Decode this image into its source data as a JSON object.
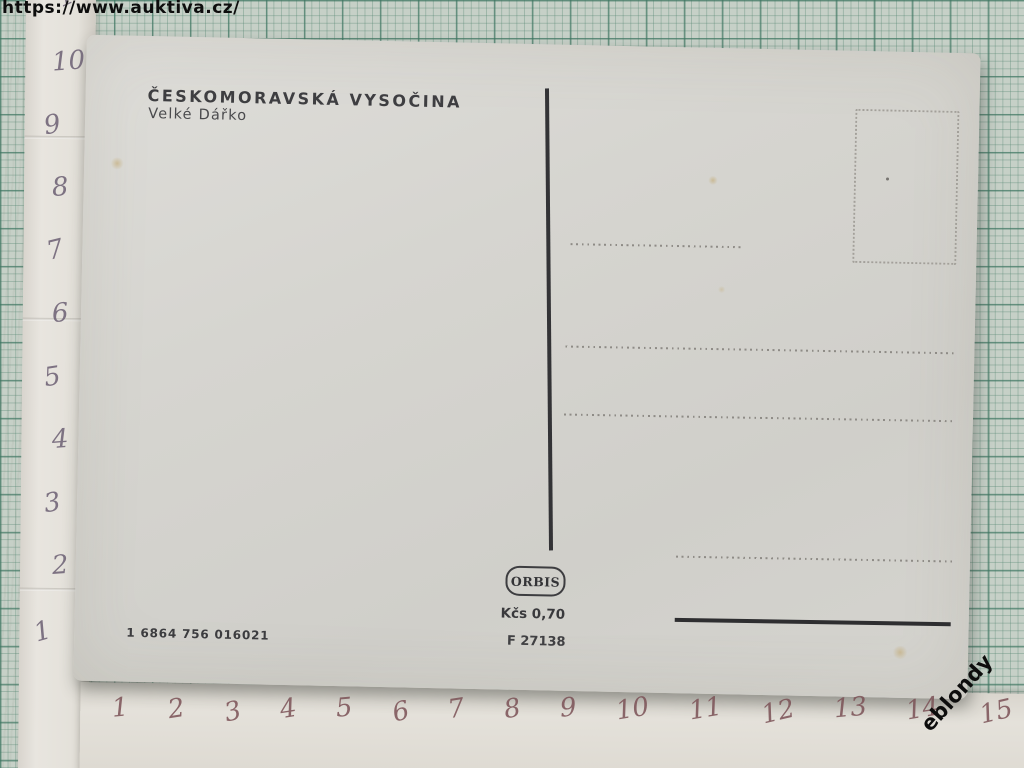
{
  "watermarks": {
    "url": "https://www.auktiva.cz/",
    "seller": "eblondy"
  },
  "postcard": {
    "title": "ČESKOMORAVSKÁ VYSOČINA",
    "subtitle": "Velké Dářko",
    "publisher_logo": "ORBIS",
    "price": "Kčs 0,70",
    "catalog_code": "F 27138",
    "print_code": "1 6864 756 016021"
  },
  "rulers": {
    "left_numbers": [
      "11",
      "10",
      "9",
      "8",
      "7",
      "6",
      "5",
      "4",
      "3",
      "2",
      "1"
    ],
    "bottom_numbers": [
      "1",
      "2",
      "3",
      "4",
      "5",
      "6",
      "7",
      "8",
      "9",
      "10",
      "11",
      "12",
      "13",
      "14",
      "15"
    ]
  },
  "colors": {
    "mat_background": "#c6d0c7",
    "mat_grid_line": "#3e7662",
    "postcard_paper": "#d6d5d0",
    "printed_ink": "#3a3a3c",
    "dotted_line": "#8e8b86",
    "handwriting_left": "#6b5f73",
    "handwriting_bottom": "#7b5156",
    "watermark_text": "#0d0d0d",
    "stain": "#c1a567"
  }
}
